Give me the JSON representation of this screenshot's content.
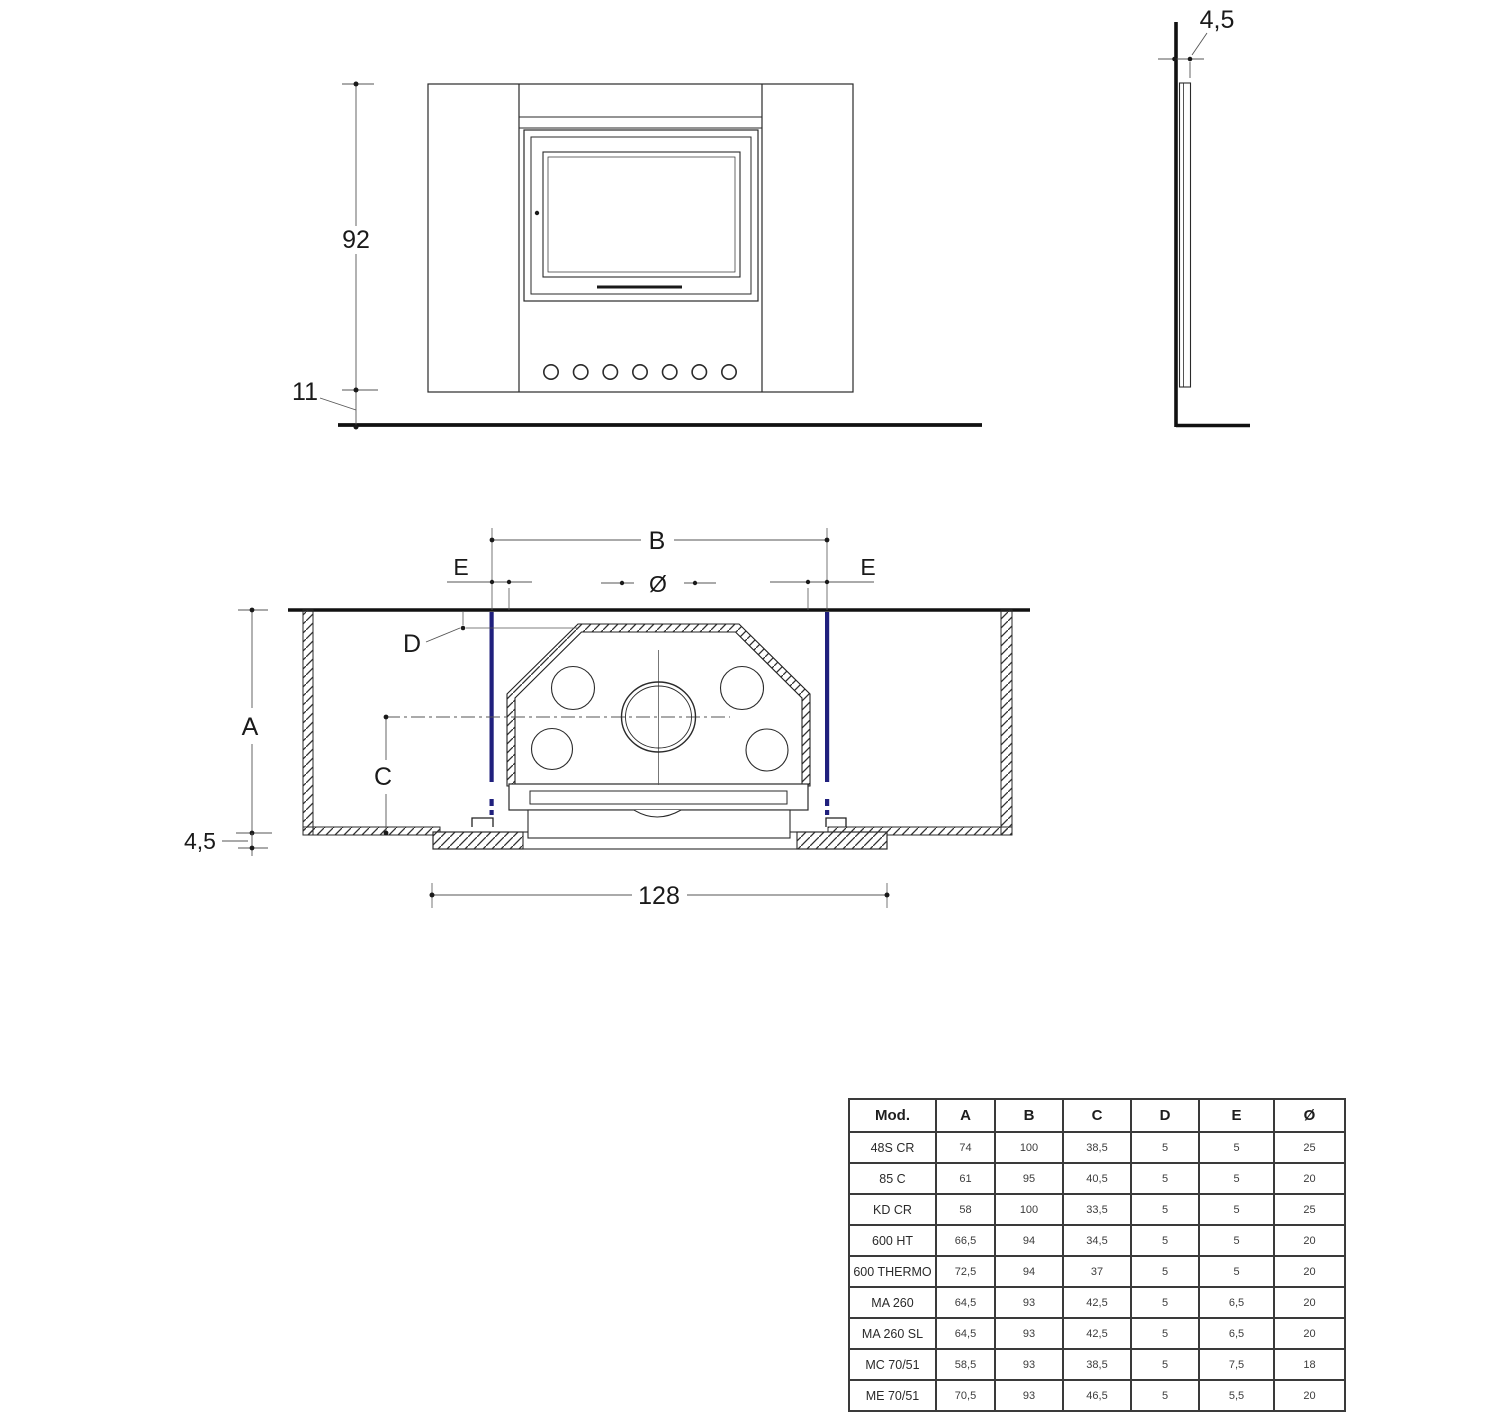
{
  "drawing_title": "fireplace-insert-installation-drawing",
  "front_view": {
    "height_label": "92",
    "plinth_height_label": "11"
  },
  "side_view": {
    "panel_thickness_label": "4,5"
  },
  "plan_view": {
    "width_label": "B",
    "inset_left_label": "E",
    "inset_right_label": "E",
    "flue_diameter_label": "Ø",
    "wall_offset_label": "D",
    "depth_label": "A",
    "center_distance_label": "C",
    "plate_thickness_label": "4,5",
    "overall_width_label": "128"
  },
  "colors": {
    "line": "#2a2a2a",
    "dim_line": "#5a5a5a",
    "accent_blue": "#20207d"
  },
  "table": {
    "headers": [
      "Mod.",
      "A",
      "B",
      "C",
      "D",
      "E",
      "Ø"
    ],
    "rows": [
      [
        "48S CR",
        "74",
        "100",
        "38,5",
        "5",
        "5",
        "25"
      ],
      [
        "85 C",
        "61",
        "95",
        "40,5",
        "5",
        "5",
        "20"
      ],
      [
        "KD CR",
        "58",
        "100",
        "33,5",
        "5",
        "5",
        "25"
      ],
      [
        "600 HT",
        "66,5",
        "94",
        "34,5",
        "5",
        "5",
        "20"
      ],
      [
        "600 THERMO",
        "72,5",
        "94",
        "37",
        "5",
        "5",
        "20"
      ],
      [
        "MA 260",
        "64,5",
        "93",
        "42,5",
        "5",
        "6,5",
        "20"
      ],
      [
        "MA 260 SL",
        "64,5",
        "93",
        "42,5",
        "5",
        "6,5",
        "20"
      ],
      [
        "MC 70/51",
        "58,5",
        "93",
        "38,5",
        "5",
        "7,5",
        "18"
      ],
      [
        "ME 70/51",
        "70,5",
        "93",
        "46,5",
        "5",
        "5,5",
        "20"
      ]
    ]
  }
}
